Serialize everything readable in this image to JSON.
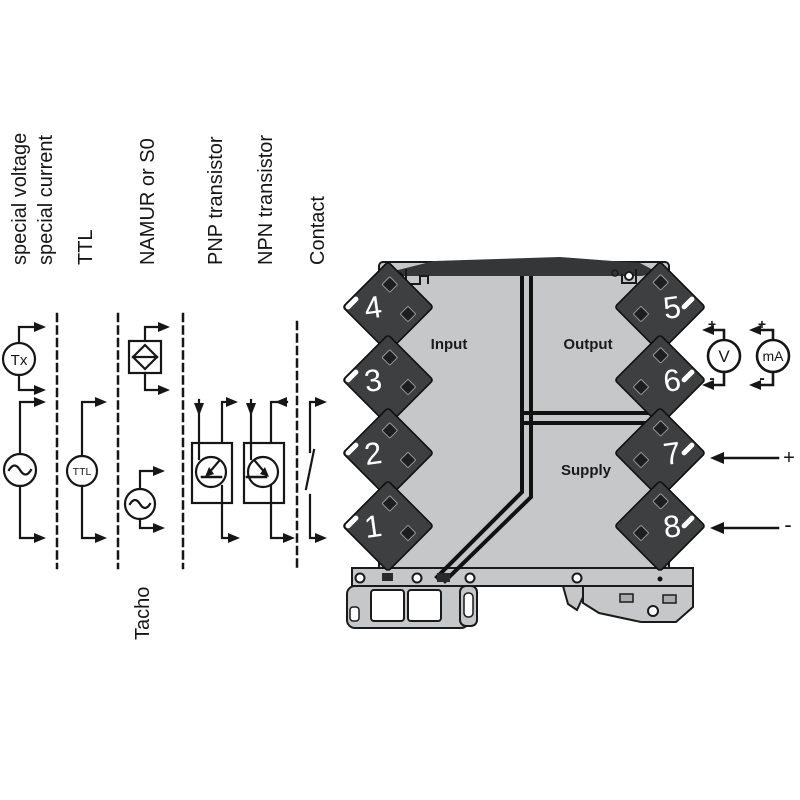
{
  "columns": {
    "labels": [
      "special voltage",
      "special current",
      "TTL",
      "NAMUR or S0",
      "PNP transistor",
      "NPN transistor",
      "Contact"
    ],
    "tacho_label": "Tacho",
    "tx_symbol": "Tx",
    "ttl_symbol": "TTL"
  },
  "module": {
    "input_label": "Input",
    "output_label": "Output",
    "supply_label": "Supply",
    "terminals_left": [
      "4",
      "3",
      "2",
      "1"
    ],
    "terminals_right": [
      "5",
      "6",
      "7",
      "8"
    ],
    "colors": {
      "body": "#c6c7c8",
      "terminal": "#3e3f41",
      "band": "#353637",
      "line": "#1a1a1a"
    }
  },
  "meters": {
    "voltmeter": "V",
    "ammeter": "mA",
    "plus": "+",
    "minus": "-"
  },
  "supply_wires": {
    "plus": "+",
    "minus": "-"
  }
}
